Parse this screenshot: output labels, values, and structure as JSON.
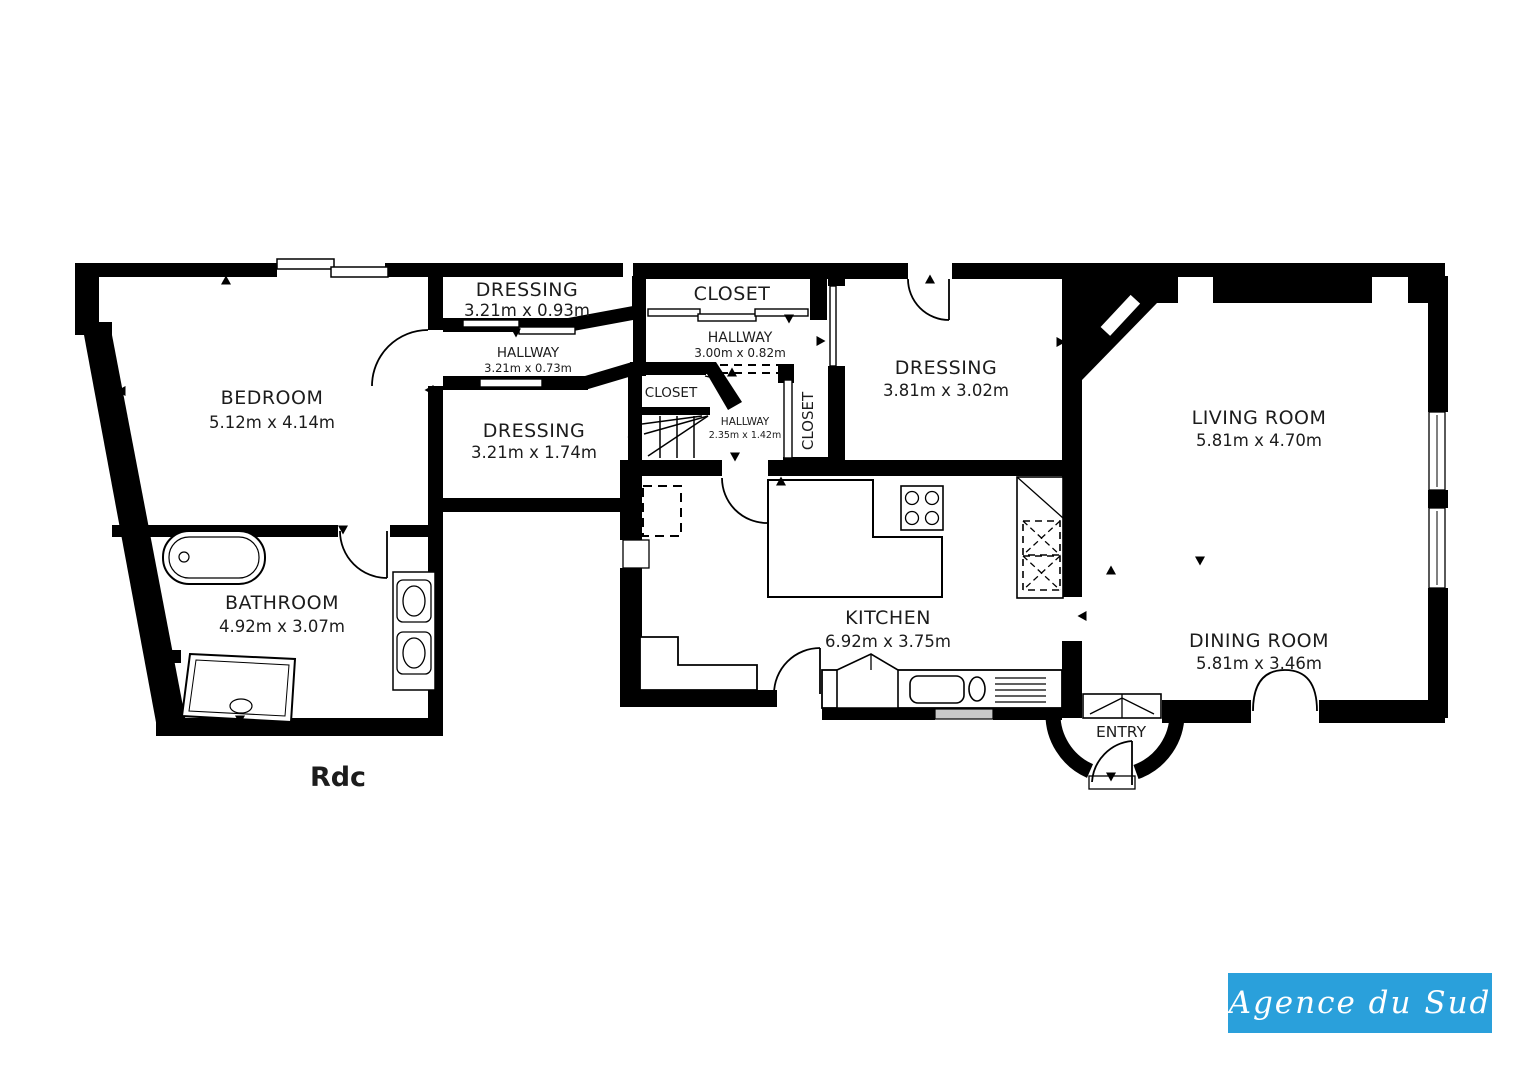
{
  "floor_plan": {
    "floor_label": "Rdc",
    "rooms": {
      "bedroom": {
        "name": "BEDROOM",
        "dims": "5.12m x 4.14m"
      },
      "bathroom": {
        "name": "BATHROOM",
        "dims": "4.92m x 3.07m"
      },
      "dressing_top": {
        "name": "DRESSING",
        "dims": "3.21m x 0.93m"
      },
      "hallway_west": {
        "name": "HALLWAY",
        "dims": "3.21m x 0.73m"
      },
      "dressing_mid": {
        "name": "DRESSING",
        "dims": "3.21m x 1.74m"
      },
      "closet_top": {
        "name": "CLOSET"
      },
      "hallway_mid": {
        "name": "HALLWAY",
        "dims": "3.00m x 0.82m"
      },
      "closet_small": {
        "name": "CLOSET"
      },
      "hallway_stairs": {
        "name": "HALLWAY",
        "dims": "2.35m x 1.42m"
      },
      "closet_vertical": {
        "name": "CLOSET"
      },
      "dressing_east": {
        "name": "DRESSING",
        "dims": "3.81m x 3.02m"
      },
      "living_room": {
        "name": "LIVING ROOM",
        "dims": "5.81m x 4.70m"
      },
      "kitchen": {
        "name": "KITCHEN",
        "dims": "6.92m x 3.75m"
      },
      "dining_room": {
        "name": "DINING ROOM",
        "dims": "5.81m x 3.46m"
      },
      "entry": {
        "name": "ENTRY"
      }
    },
    "logo": {
      "text": "Agence du Sud",
      "background": "#2AA0DB",
      "color": "#FFFFFF"
    },
    "colors": {
      "walls": "#000000",
      "background": "#FFFFFF",
      "window_glass": "#C9C9C9"
    }
  }
}
